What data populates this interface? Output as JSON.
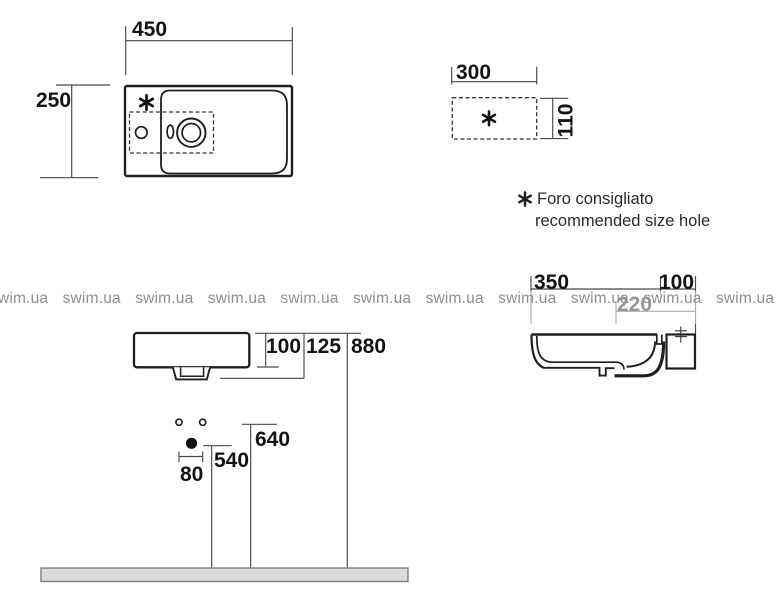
{
  "title": "Washbasin technical dimensions drawing",
  "watermark": {
    "text": "swim.ua"
  },
  "legend": {
    "symbol_icon": "asterisk-icon",
    "line1": "Foro consigliato",
    "line2": "recommended size hole"
  },
  "labels": {
    "top_view_width": "450",
    "top_view_depth": "250",
    "hole_width": "300",
    "hole_height": "110",
    "side_depth": "350",
    "side_bracket": "100",
    "side_siphon_depth": "220",
    "front_rim_height": "100",
    "front_drain_height": "125",
    "front_total_height": "880",
    "front_holes_height": "640",
    "front_outlet_height": "540",
    "front_holes_spacing": "80"
  },
  "colors": {
    "line": "#1f1f1f",
    "dim_line": "#4a4a4a",
    "label": "#141414",
    "watermark": "#8f8f8f",
    "floor_fill": "#dbdbdb",
    "floor_edge": "#808080"
  }
}
